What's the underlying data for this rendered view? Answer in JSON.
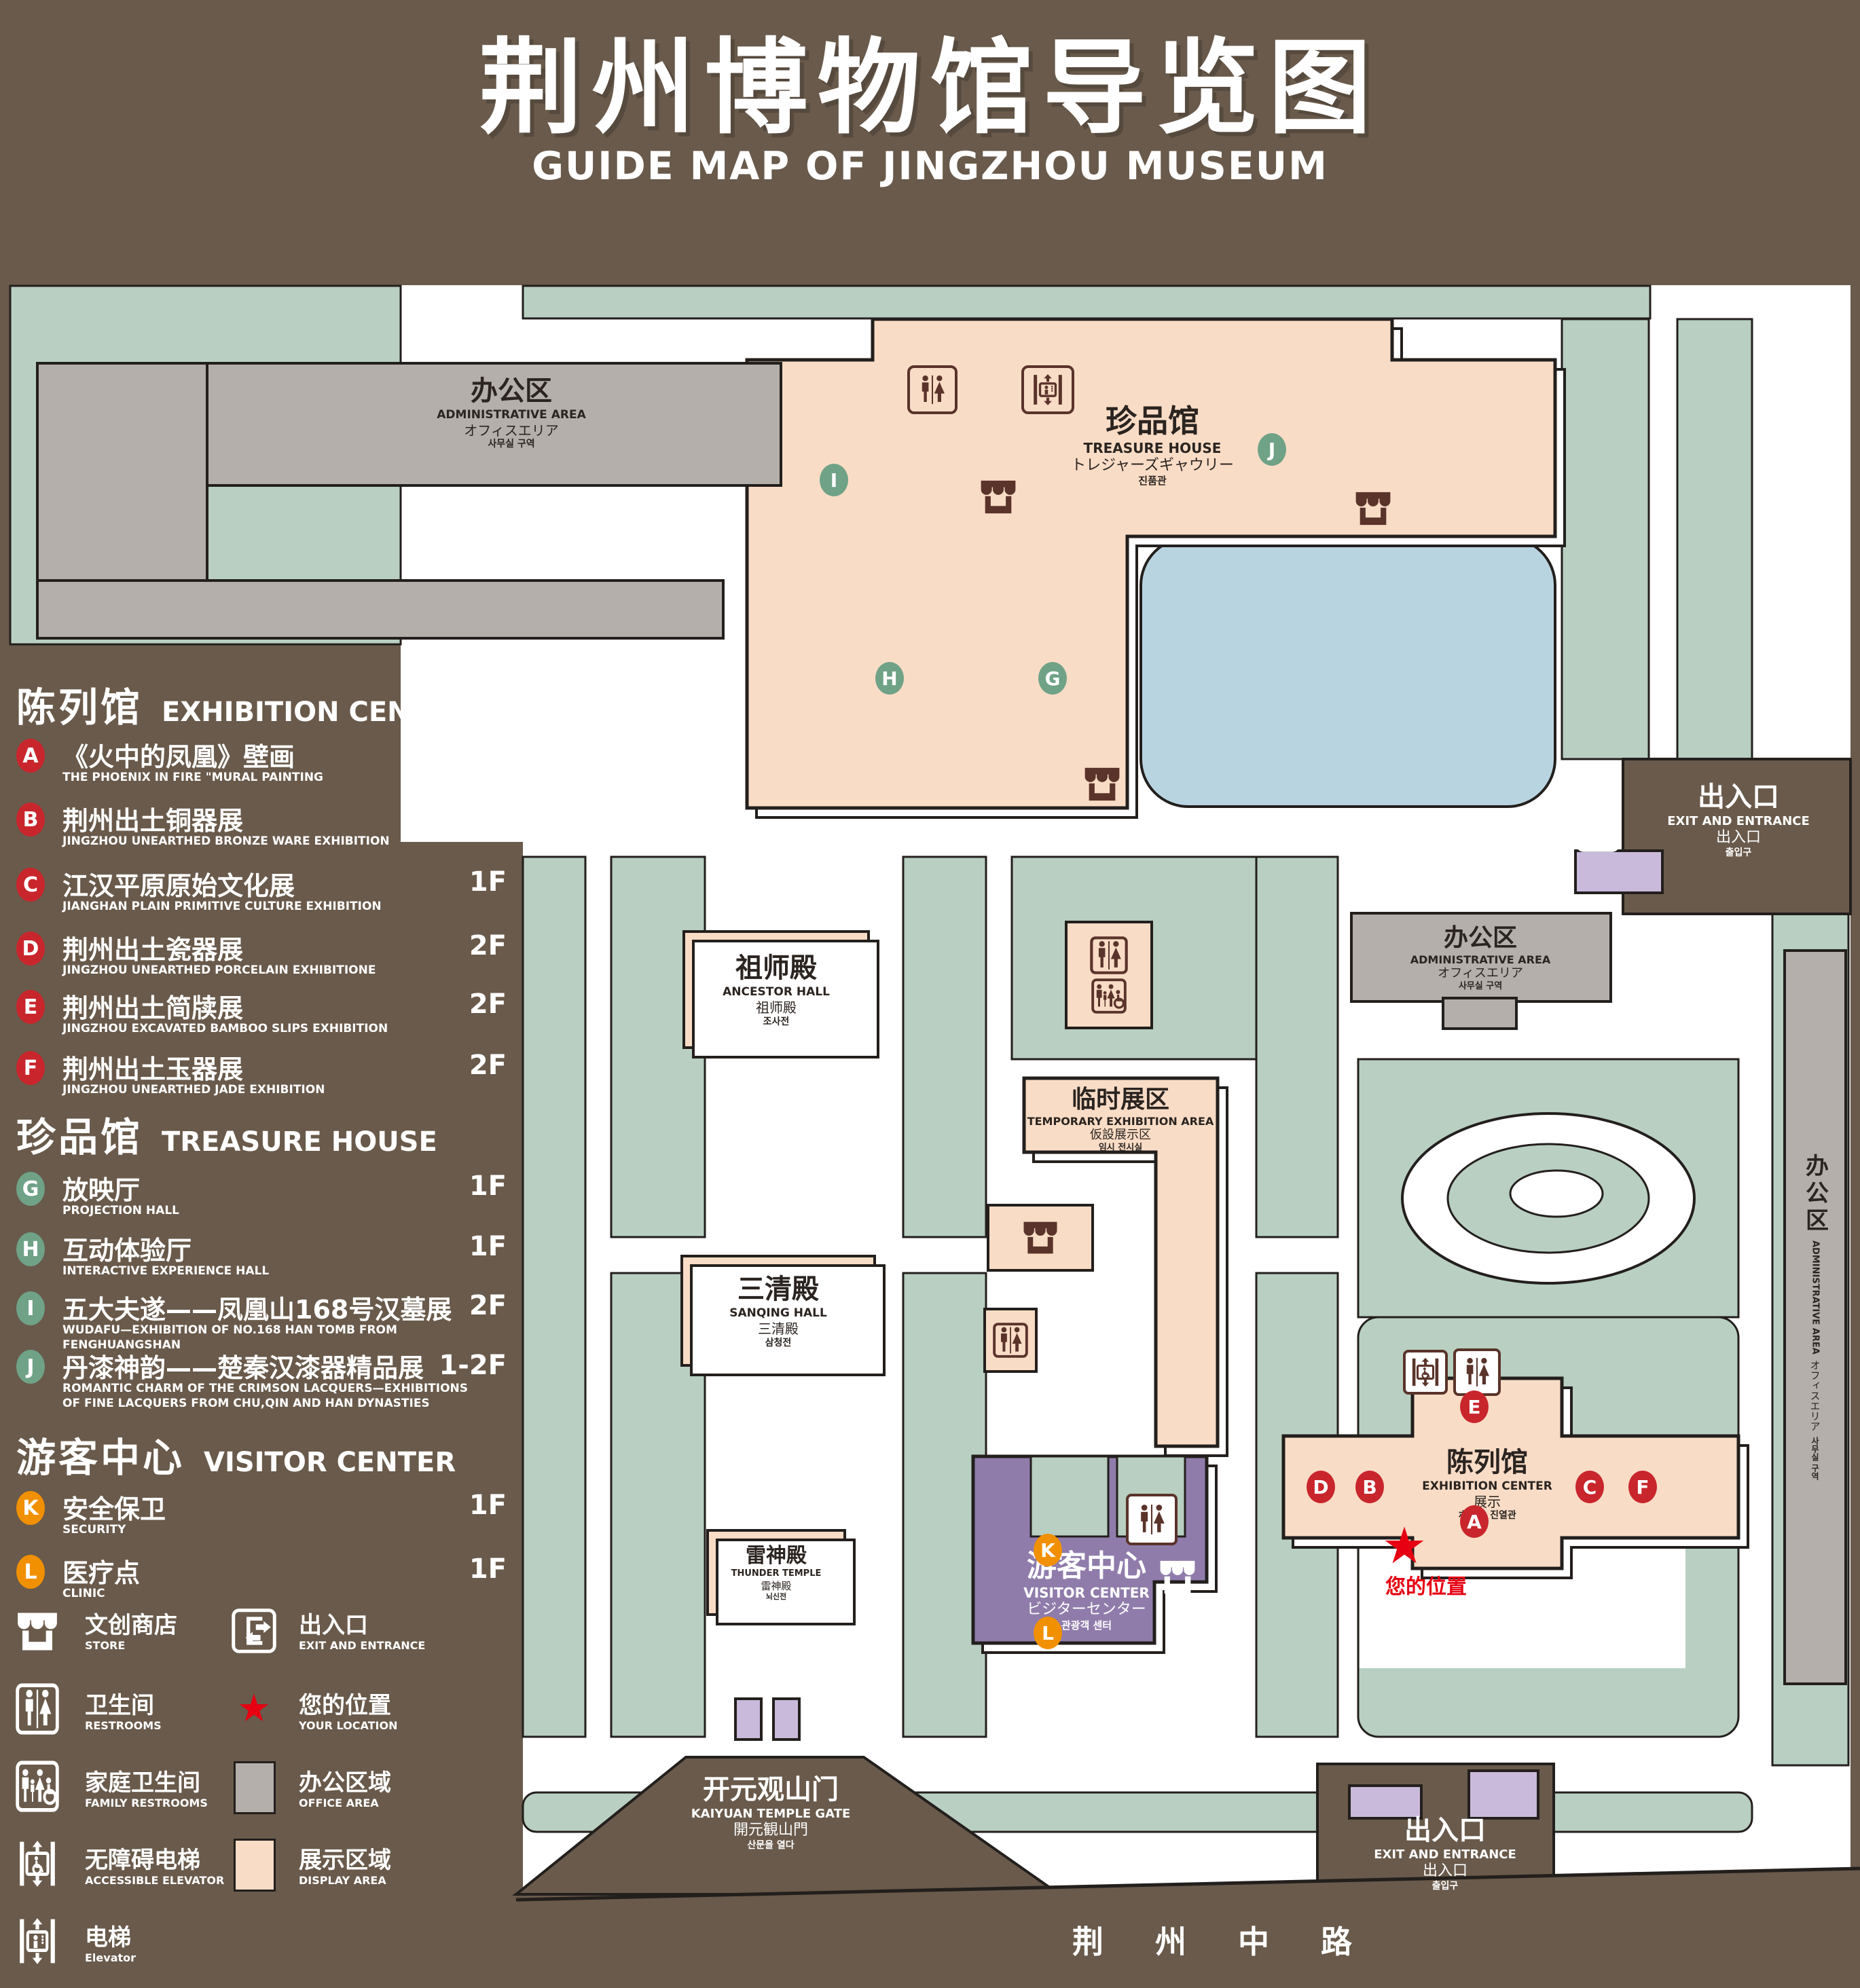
{
  "title": {
    "zh": "荆州博物馆导览图",
    "en": "GUIDE MAP OF JINGZHOU MUSEUM"
  },
  "colors": {
    "background": "#695a4b",
    "lawn": "#b8cfc1",
    "display_area": "#f9dcc6",
    "office_area": "#b4afab",
    "visitor_center": "#8f7cab",
    "gate_purple": "#c9badb",
    "pond": "#b9d4e1",
    "marker_red": "#c9252c",
    "marker_green": "#6fa287",
    "marker_orange": "#f19000",
    "icon_brown": "#5a332a",
    "location_red": "#e60012",
    "outline": "#231f1d"
  },
  "sidebar": {
    "sections": [
      {
        "zh": "陈列馆",
        "en": "EXHIBITION CENTER",
        "items": [
          {
            "id": "A",
            "zh": "《火中的凤凰》壁画",
            "en": "THE PHOENIX IN FIRE \"MURAL PAINTING",
            "floor": "1F"
          },
          {
            "id": "B",
            "zh": "荆州出土铜器展",
            "en": "JINGZHOU UNEARTHED BRONZE WARE EXHIBITION",
            "floor": "1F"
          },
          {
            "id": "C",
            "zh": "江汉平原原始文化展",
            "en": "JIANGHAN PLAIN PRIMITIVE CULTURE EXHIBITION",
            "floor": "1F"
          },
          {
            "id": "D",
            "zh": "荆州出土瓷器展",
            "en": "JINGZHOU UNEARTHED PORCELAIN EXHIBITIONE",
            "floor": "2F"
          },
          {
            "id": "E",
            "zh": "荆州出土简牍展",
            "en": "JINGZHOU EXCAVATED BAMBOO SLIPS EXHIBITION",
            "floor": "2F"
          },
          {
            "id": "F",
            "zh": "荆州出土玉器展",
            "en": "JINGZHOU UNEARTHED JADE EXHIBITION",
            "floor": "2F"
          }
        ]
      },
      {
        "zh": "珍品馆",
        "en": "TREASURE HOUSE",
        "items": [
          {
            "id": "G",
            "zh": "放映厅",
            "en": "PROJECTION HALL",
            "floor": "1F"
          },
          {
            "id": "H",
            "zh": "互动体验厅",
            "en": "INTERACTIVE EXPERIENCE HALL",
            "floor": "1F"
          },
          {
            "id": "I",
            "zh": "五大夫遂——凤凰山168号汉墓展",
            "en": "WUDAFU—EXHIBITION OF NO.168 HAN TOMB FROM FENGHUANGSHAN",
            "floor": "2F"
          },
          {
            "id": "J",
            "zh": "丹漆神韵——楚秦汉漆器精品展",
            "en": "ROMANTIC CHARM OF THE CRIMSON LACQUERS—EXHIBITIONS OF FINE LACQUERS FROM CHU,QIN AND HAN DYNASTIES",
            "floor": "1-2F"
          }
        ]
      },
      {
        "zh": "游客中心",
        "en": "VISITOR CENTER",
        "items": [
          {
            "id": "K",
            "zh": "安全保卫",
            "en": "SECURITY",
            "floor": "1F"
          },
          {
            "id": "L",
            "zh": "医疗点",
            "en": "CLINIC",
            "floor": "1F"
          }
        ]
      }
    ]
  },
  "legend": {
    "items": [
      {
        "icon": "store-icon",
        "zh": "文创商店",
        "en": "STORE"
      },
      {
        "icon": "exit-icon",
        "zh": "出入口",
        "en": "EXIT AND ENTRANCE"
      },
      {
        "icon": "restrooms-icon",
        "zh": "卫生间",
        "en": "RESTROOMS"
      },
      {
        "icon": "your-location-star",
        "zh": "您的位置",
        "en": "YOUR LOCATION"
      },
      {
        "icon": "family-restrooms-icon",
        "zh": "家庭卫生间",
        "en": "FAMILY RESTROOMS"
      },
      {
        "icon": "office-area-swatch",
        "zh": "办公区域",
        "en": "OFFICE AREA"
      },
      {
        "icon": "accessible-elevator-icon",
        "zh": "无障碍电梯",
        "en": "ACCESSIBLE ELEVATOR"
      },
      {
        "icon": "display-area-swatch",
        "zh": "展示区域",
        "en": "DISPLAY AREA"
      },
      {
        "icon": "elevator-icon",
        "zh": "电梯",
        "en": "Elevator"
      }
    ]
  },
  "map": {
    "admin_tl": {
      "zh": "办公区",
      "en": "ADMINISTRATIVE AREA",
      "ja": "オフィスエリア",
      "ko": "사무실 구역"
    },
    "treasure": {
      "zh": "珍品馆",
      "en": "TREASURE HOUSE",
      "ja": "トレジャーズギャウリー",
      "ko": "진품관"
    },
    "ancestor": {
      "zh": "祖师殿",
      "en": "ANCESTOR HALL",
      "ja": "祖师殿",
      "ko": "조사전"
    },
    "temporary": {
      "zh": "临时展区",
      "en": "TEMPORARY EXHIBITION AREA",
      "ja": "仮設展示区",
      "ko": "임시 전시실"
    },
    "admin_r": {
      "zh": "办公区",
      "en": "ADMINISTRATIVE AREA",
      "ja": "オフィスエリア",
      "ko": "사무실 구역"
    },
    "admin_strip": {
      "zh": "办公区",
      "en": "ADMINISTRATIVE AREA",
      "ja": "オフィスエリア",
      "ko": "사무실 구역"
    },
    "sanqing": {
      "zh": "三清殿",
      "en": "SANQING HALL",
      "ja": "三清殿",
      "ko": "삼청전"
    },
    "thunder": {
      "zh": "雷神殿",
      "en": "THUNDER TEMPLE",
      "ja": "雷神殿",
      "ko": "뇌신전"
    },
    "visitor": {
      "zh": "游客中心",
      "en": "VISITOR CENTER",
      "ja": "ビジターセンター",
      "ko": "관광객 센터"
    },
    "exhibition": {
      "zh": "陈列馆",
      "en": "EXHIBITION CENTER",
      "ja": "展示",
      "ko": "ホール  진열관"
    },
    "gate": {
      "zh": "开元观山门",
      "en": "KAIYUAN TEMPLE GATE",
      "ja": "開元観山門",
      "ko": "산문을 열다"
    },
    "exit_top": {
      "zh": "出入口",
      "en": "EXIT AND ENTRANCE",
      "ja": "出入口",
      "ko": "출입구"
    },
    "exit_bottom": {
      "zh": "出入口",
      "en": "EXIT AND ENTRANCE",
      "ja": "出入口",
      "ko": "출입구"
    },
    "road": {
      "zh": "荆 州 中 路"
    },
    "your_location": {
      "zh": "您的位置"
    },
    "markers": {
      "A": "A",
      "B": "B",
      "C": "C",
      "D": "D",
      "E": "E",
      "F": "F",
      "G": "G",
      "H": "H",
      "I": "I",
      "J": "J",
      "K": "K",
      "L": "L"
    }
  }
}
